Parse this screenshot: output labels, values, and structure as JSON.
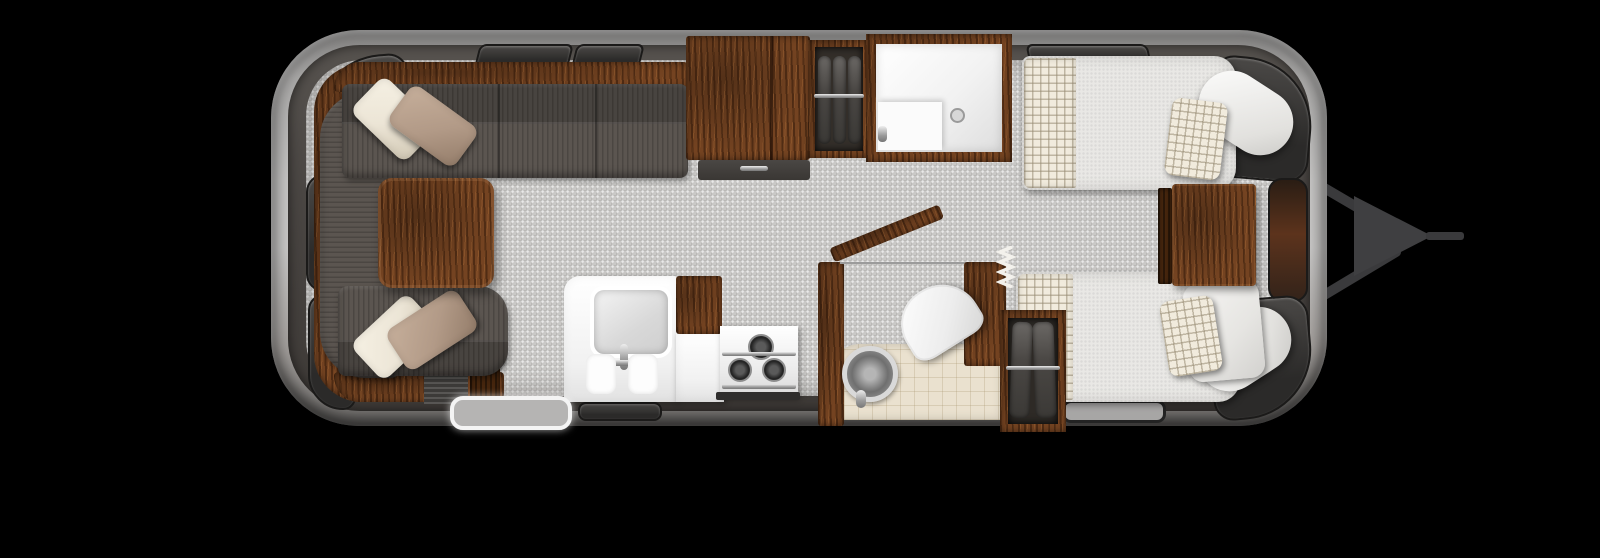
{
  "scene": {
    "description": "Top-down 3D rendered floor plan of an aluminum travel trailer: rear wraparound lounge with table, galley kitchen with sink and cooktop, pantry, hanging wardrobes, shower, bath with toilet and round vanity sink, and front twin beds with nightstand; hitch tongue pointing right on a black background.",
    "background_color": "#000000"
  },
  "colors": {
    "bg": "#000000",
    "shell-hi": "#c6c5c4",
    "shell-mid": "#a9a8a7",
    "shell-lo": "#6f6d6b",
    "wall": "#4a4643",
    "floor": "#c9c8c6",
    "wood": "#744321",
    "wood-dark": "#46260e",
    "wood-hi": "#9c6334",
    "sofa": "#5b5550",
    "cream": "#ece5d6",
    "tan": "#b29a87",
    "mattress": "#e9e8e5",
    "plaid": "#f1ebdd",
    "plaid-line": "#b3a78f",
    "white-fixture": "#fbfbfb",
    "bath-floor": "#eae1cf",
    "chrome": "#c9c9c9",
    "glass": "#2b2a29",
    "hitch": "#3a3a3c"
  },
  "regions": {
    "shell": {
      "name": "Trailer shell (aluminum body, rounded ends)"
    },
    "lounge": {
      "name": "Wraparound lounge sofa with throw pillows and wood table"
    },
    "kitchen": {
      "name": "Galley counter with square sink and three-burner cooktop"
    },
    "pantry": {
      "name": "Pantry / refrigerator cabinet"
    },
    "closet": {
      "name": "Hanging wardrobe with clothes"
    },
    "shower": {
      "name": "Shower stall with bench and drain"
    },
    "bath": {
      "name": "Bath with swinging wood door, toilet and round vanity sink"
    },
    "wardrobe": {
      "name": "Front wardrobe with hanging clothes"
    },
    "bedroom": {
      "name": "Twin beds with plaid runners, plaid pillows and wood nightstand"
    },
    "entry": {
      "name": "Entry step"
    },
    "windows": {
      "name": "Tinted windows around perimeter"
    },
    "hitch": {
      "name": "A-frame hitch tongue with coupler"
    }
  }
}
